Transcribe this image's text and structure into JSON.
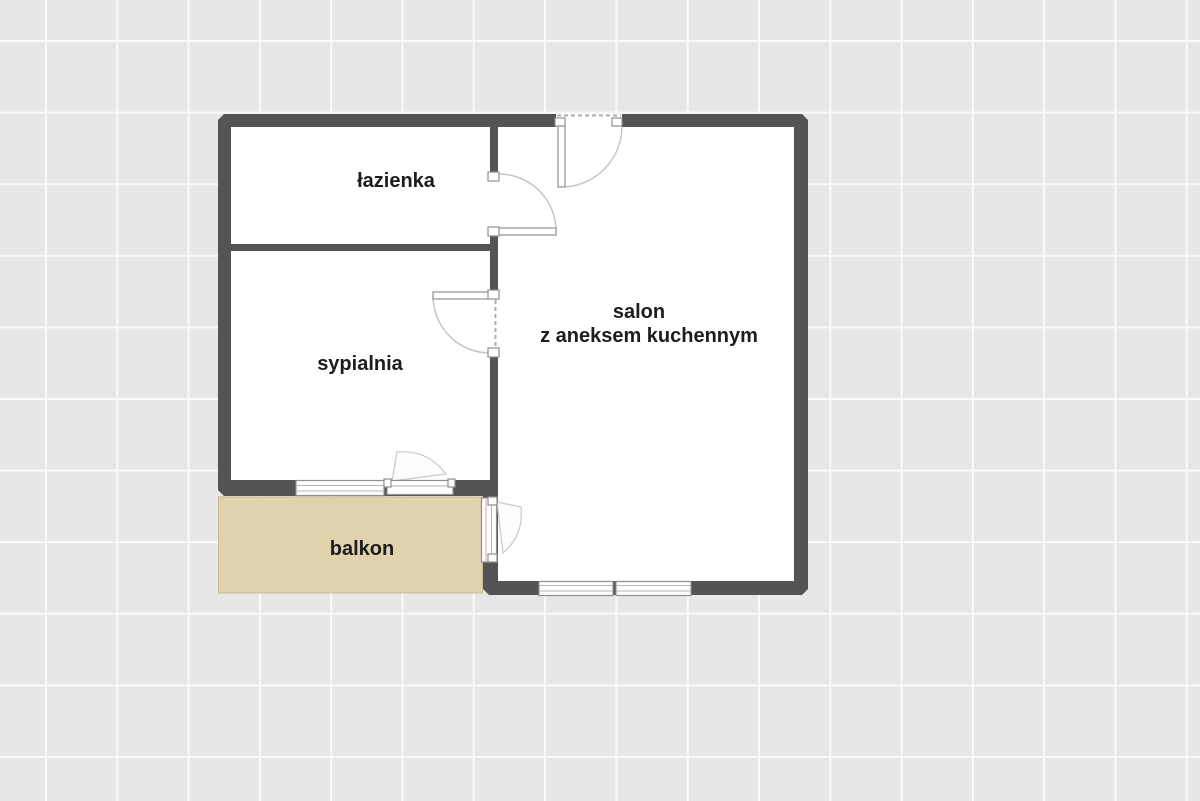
{
  "plan": {
    "type": "floor-plan",
    "rooms": [
      {
        "id": "lazienka",
        "label": "łazienka"
      },
      {
        "id": "sypialnia",
        "label": "sypialnia"
      },
      {
        "id": "salon",
        "label_line1": "salon",
        "label_line2": "z aneksem kuchennym"
      },
      {
        "id": "balkon",
        "label": "balkon"
      }
    ],
    "colors": {
      "background": "#e7e7e7",
      "grid_line": "#fafafa",
      "wall": "#545454",
      "room_fill": "#ffffff",
      "balcony_fill": "#e0d2ac",
      "balcony_border": "#c9ba92",
      "label_text": "#1d1d1d",
      "frame": "#8f8f8f",
      "swing": "#c6c6c6"
    }
  }
}
